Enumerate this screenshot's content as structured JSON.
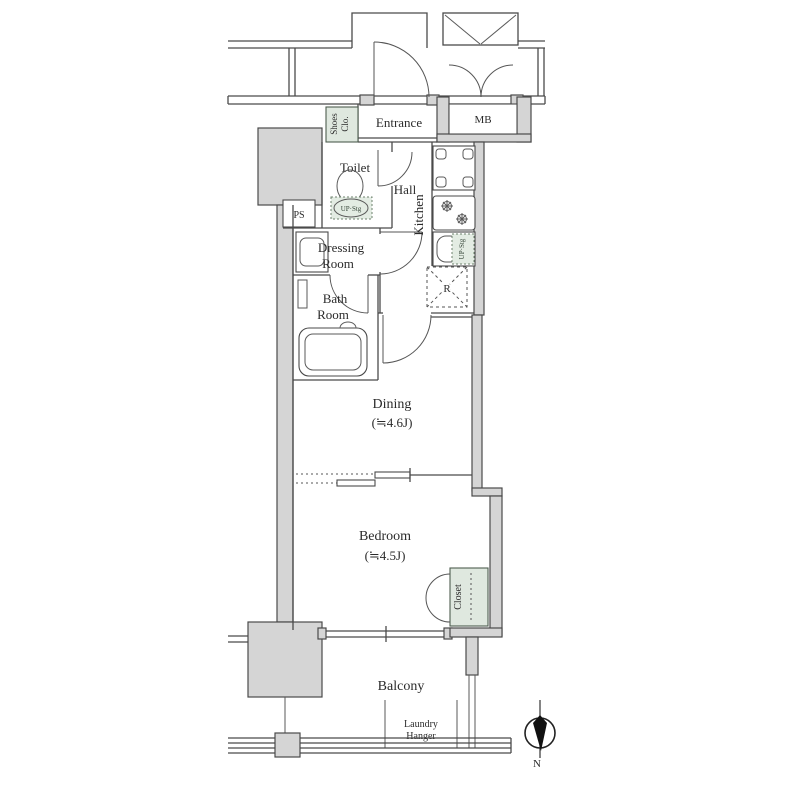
{
  "rooms": {
    "entrance": "Entrance",
    "toilet": "Toilet",
    "hall": "Hall",
    "kitchen": "Kitchen",
    "dressing_1": "Dressing",
    "dressing_2": "Room",
    "bath_1": "Bath",
    "bath_2": "Room",
    "dining": "Dining",
    "dining_size": "(≒4.6J)",
    "bedroom": "Bedroom",
    "bedroom_size": "(≒4.5J)",
    "balcony": "Balcony"
  },
  "storage": {
    "shoes_1": "Shoes",
    "shoes_2": "Clo.",
    "closet": "Closet",
    "toilet_upper": "UP·Stg",
    "kitchen_upper": "UP·Stg"
  },
  "labels": {
    "mb": "MB",
    "ps": "PS",
    "refrigerator": "R",
    "laundry_1": "Laundry",
    "laundry_2": "Hanger",
    "north": "N"
  },
  "colors": {
    "wall": "#4a4a4a",
    "structure_fill": "#d5d5d5",
    "storage_fill": "#dfe8df",
    "text": "#2b2b2b",
    "background": "#ffffff"
  }
}
